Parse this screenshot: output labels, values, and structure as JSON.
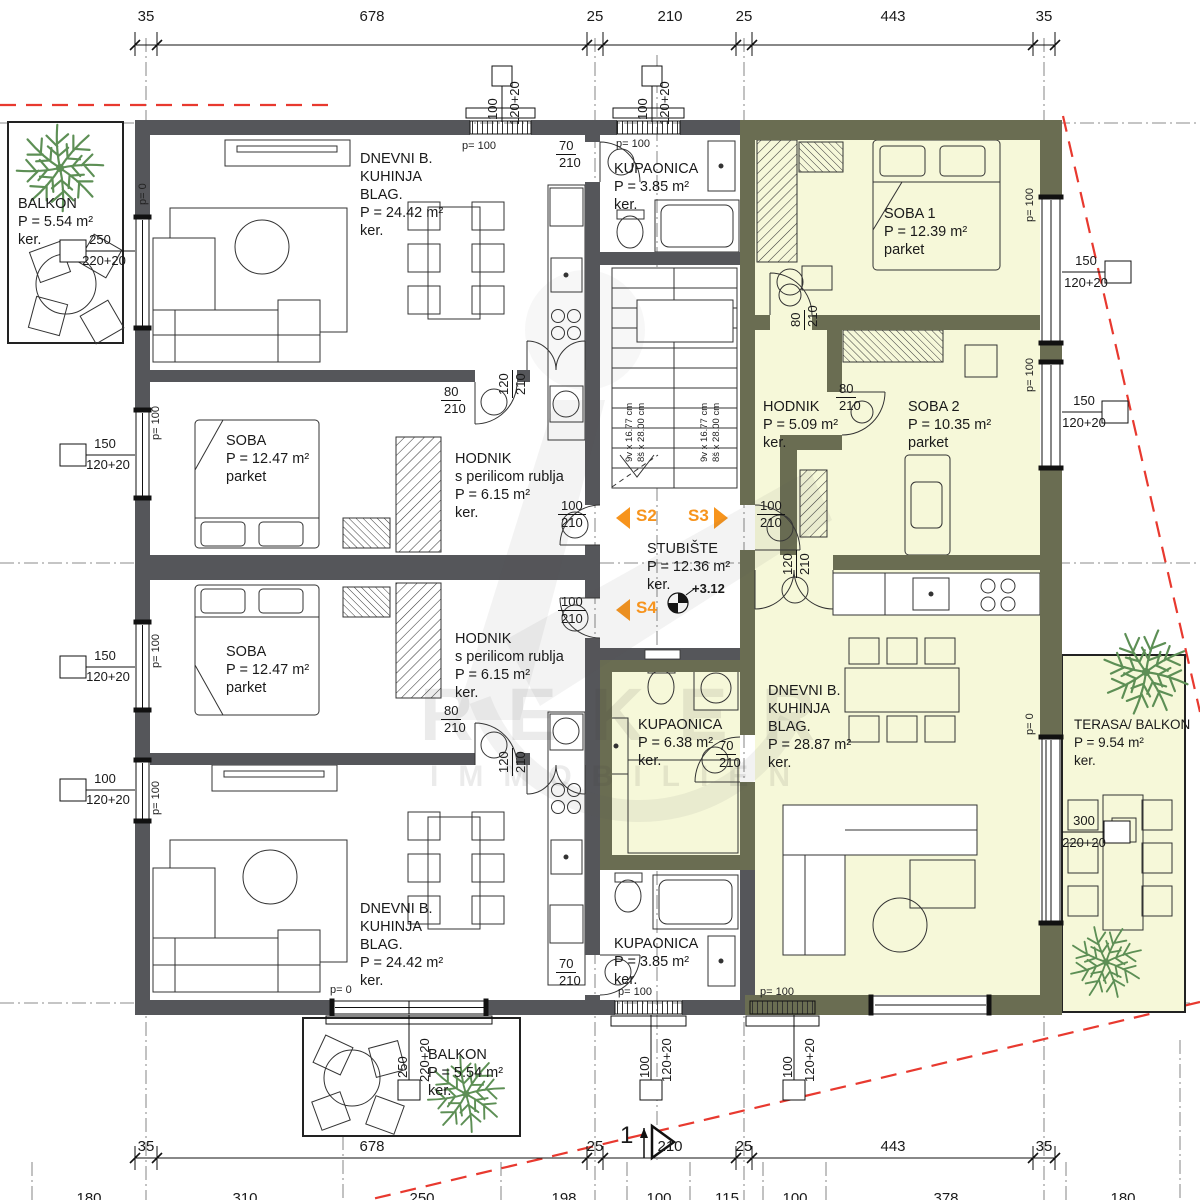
{
  "colors": {
    "wall_dark": "#55565A",
    "wall_olive": "#6A6D52",
    "floor_highlight": "#F6F8D9",
    "accent_orange": "#F7941D",
    "boundary_red": "#E8392F",
    "plant_green": "#5D8F55"
  },
  "watermark": {
    "brand": "REKER",
    "sub": "IMMOBILIEN"
  },
  "dims": {
    "top": [
      "35",
      "678",
      "25",
      "210",
      "25",
      "443",
      "35"
    ],
    "bottom": [
      "35",
      "678",
      "25",
      "210",
      "25",
      "443",
      "35"
    ],
    "bottom2": [
      "180",
      "310",
      "250",
      "198",
      "100",
      "115",
      "100",
      "378",
      "180"
    ]
  },
  "rooms": {
    "balkon_tl": {
      "lines": [
        "BALKON",
        "P = 5.54 m²",
        "ker."
      ]
    },
    "dnevni_tl": {
      "lines": [
        "DNEVNI B.",
        "KUHINJA",
        "BLAG.",
        "P = 24.42 m²",
        "ker."
      ]
    },
    "kupaonica_t": {
      "lines": [
        "KUPAONICA",
        "P = 3.85 m²",
        "ker."
      ]
    },
    "soba1": {
      "lines": [
        "SOBA 1",
        "P = 12.39 m²",
        "parket"
      ]
    },
    "soba_tl": {
      "lines": [
        "SOBA",
        "P = 12.47 m²",
        "parket"
      ]
    },
    "hodnik_tl": {
      "lines": [
        "HODNIK",
        "s perilicom rublja",
        "P = 6.15 m²",
        "ker."
      ]
    },
    "hodnik_r": {
      "lines": [
        "HODNIK",
        "P = 5.09 m²",
        "ker."
      ]
    },
    "soba2": {
      "lines": [
        "SOBA 2",
        "P = 10.35 m²",
        "parket"
      ]
    },
    "stubiste": {
      "lines": [
        "STUBIŠTE",
        "P = 12.36 m²",
        "ker."
      ]
    },
    "soba_bl": {
      "lines": [
        "SOBA",
        "P = 12.47 m²",
        "parket"
      ]
    },
    "hodnik_bl": {
      "lines": [
        "HODNIK",
        "s perilicom rublja",
        "P = 6.15 m²",
        "ker."
      ]
    },
    "kupaonica_r": {
      "lines": [
        "KUPAONICA",
        "P = 6.38 m²",
        "ker."
      ]
    },
    "dnevni_r": {
      "lines": [
        "DNEVNI B.",
        "KUHINJA",
        "BLAG.",
        "P = 28.87 m²",
        "ker."
      ]
    },
    "terasa": {
      "lines": [
        "TERASA/ BALKON",
        "P = 9.54 m²",
        "ker."
      ]
    },
    "dnevni_bl": {
      "lines": [
        "DNEVNI B.",
        "KUHINJA",
        "BLAG.",
        "P = 24.42 m²",
        "ker."
      ]
    },
    "kupaonica_b": {
      "lines": [
        "KUPAONICA",
        "P = 3.85 m²",
        "ker."
      ]
    },
    "balkon_b": {
      "lines": [
        "BALKON",
        "P = 5.54 m²",
        "ker."
      ]
    }
  },
  "callouts": {
    "w250a": "250",
    "w250b": "220+20",
    "w150a": "150",
    "w150b": "120+20",
    "w100a": "100",
    "w100b": "120+20",
    "w300a": "300",
    "w300b": "220+20",
    "d70a": "70",
    "d80a": "80",
    "d100a": "100",
    "d120a": "120",
    "dh": "210"
  },
  "plabels": {
    "p0": "p= 0",
    "p100": "p= 100"
  },
  "stairs": {
    "l1": "9v x 16.77 cm",
    "l2": "8š x 28.00 cm"
  },
  "markers": {
    "s2": "S2",
    "s3": "S3",
    "s4": "S4",
    "level": "+3.12",
    "section": "1"
  }
}
